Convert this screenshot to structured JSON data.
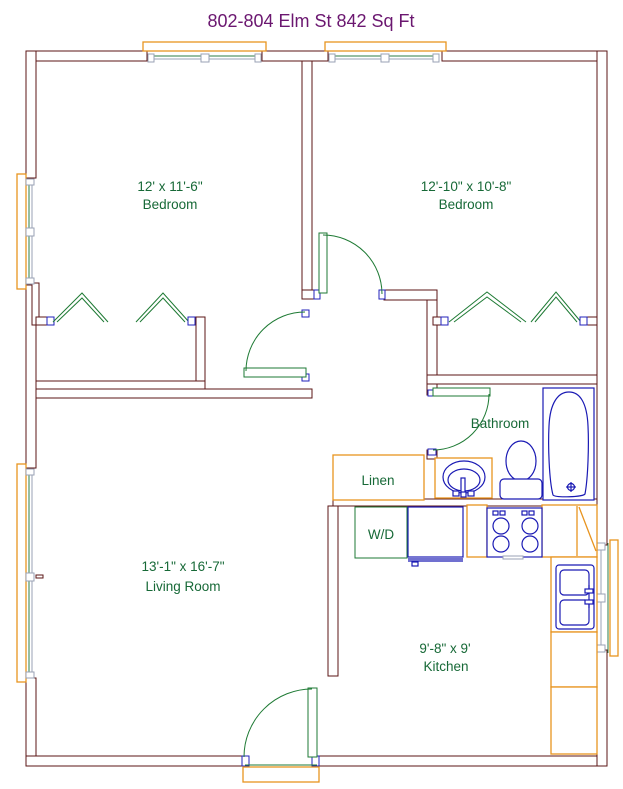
{
  "title": "802-804 Elm St  842 Sq Ft",
  "rooms": {
    "bedroom_left": {
      "dimensions": "12' x 11'-6\"",
      "label": "Bedroom"
    },
    "bedroom_right": {
      "dimensions": "12'-10\" x 10'-8\"",
      "label": "Bedroom"
    },
    "living_room": {
      "dimensions": "13'-1\" x 16'-7\"",
      "label": "Living Room"
    },
    "kitchen": {
      "dimensions": "9'-8\" x 9'",
      "label": "Kitchen"
    },
    "bathroom": {
      "label": "Bathroom"
    },
    "linen_closet": {
      "label": "Linen"
    },
    "washer_dryer": {
      "label": "W/D"
    }
  },
  "fixtures": [
    "bathtub",
    "toilet",
    "bathroom-sink-vanity",
    "kitchen-sink",
    "stove",
    "washer-dryer-unit",
    "linen-cabinet",
    "entry-stoop"
  ],
  "colors": {
    "wall": "#5B1616",
    "cabinet_orange": "#E8941F",
    "fixture_blue": "#1A1AB4",
    "door_green": "#1E7A34",
    "label_green": "#176937",
    "title_purple": "#6B1770",
    "window_gray": "#9AA2B4"
  }
}
